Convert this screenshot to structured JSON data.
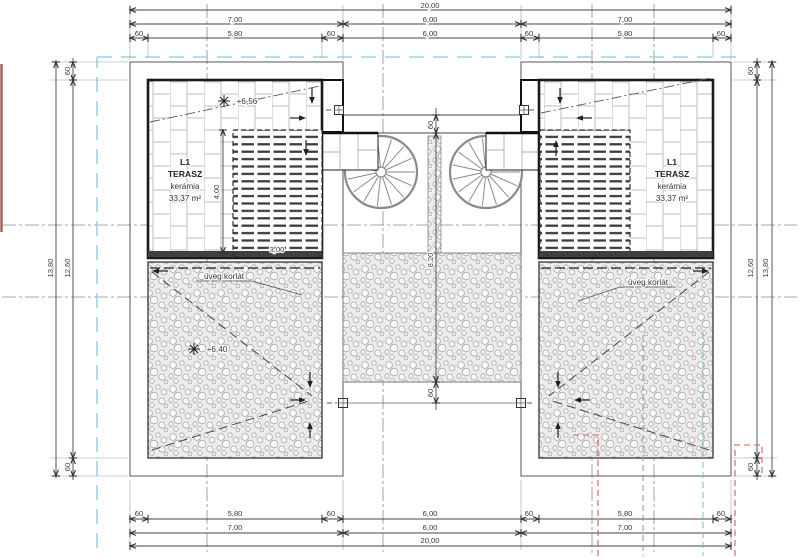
{
  "drawing": {
    "type": "architectural-floor-plan-terrace-level"
  },
  "dimensions": {
    "total_width": "20,00",
    "wing_width": "7,00",
    "court_width": "6,00",
    "terrace_width": "5,80",
    "offset": "60",
    "total_height": "13,80",
    "inner_height": "12,60",
    "court_height": "8,20",
    "deck_height": "4,00",
    "deck_width": "3,00"
  },
  "labels": {
    "terrace_id": "L1",
    "terrace_name": "TERASZ",
    "terrace_material": "kerámia",
    "terrace_area": "33,37 m²",
    "glass_railing": "üveg korlát",
    "elevation_upper": "+6,56",
    "elevation_lower": "+6,40"
  },
  "colors": {
    "line": "#3a3a3a",
    "boundary_blue": "#9fd0e8",
    "reference_red": "#e05555",
    "reference_darkred": "#b98080",
    "reference_green": "#7cc89a"
  }
}
